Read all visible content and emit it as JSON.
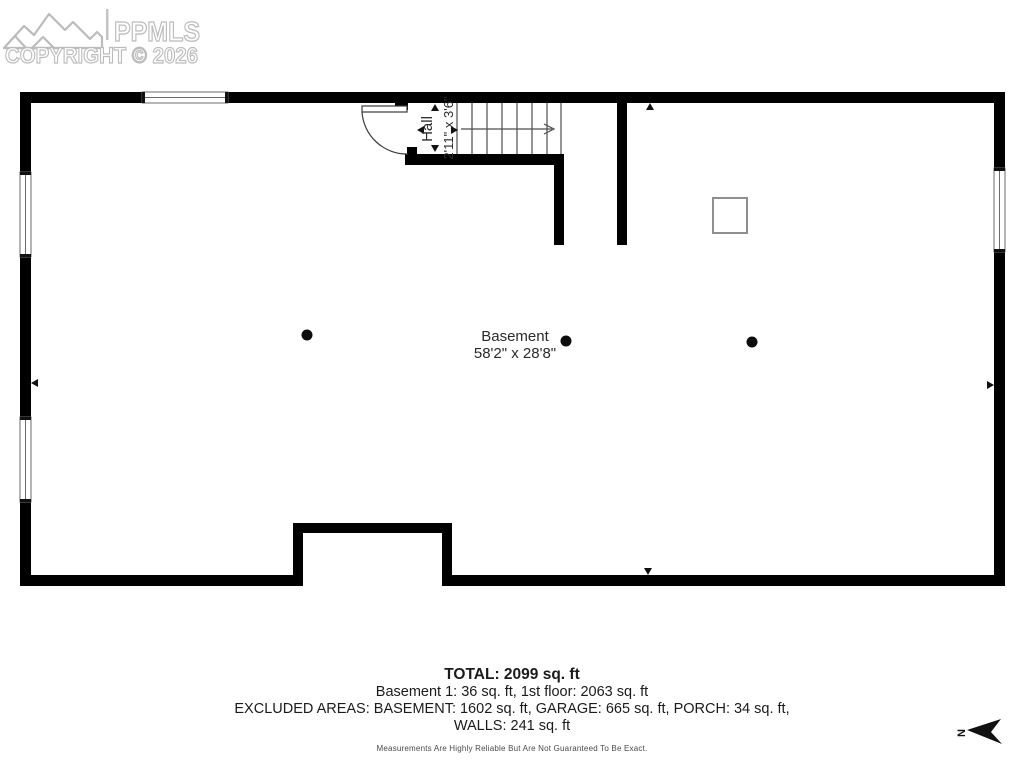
{
  "watermark": {
    "brand": "PPMLS",
    "copyright": "COPYRIGHT © 2026",
    "color": "#bcbcbc"
  },
  "floorplan": {
    "rooms": {
      "hall": {
        "name": "Hall",
        "dims": "2'11\" x 3'6\""
      },
      "basement": {
        "name": "Basement",
        "dims": "58'2\" x 28'8\""
      }
    },
    "wall_color": "#000000",
    "features": [
      "stairs-up",
      "entry-door",
      "three-support-posts",
      "utility-box",
      "four-windows",
      "bottom-bump-out"
    ]
  },
  "summary": {
    "total": "TOTAL: 2099 sq. ft",
    "breakdown": "Basement 1: 36 sq. ft, 1st floor: 2063 sq. ft",
    "excluded": "EXCLUDED AREAS: BASEMENT: 1602 sq. ft, GARAGE: 665 sq. ft, PORCH: 34 sq. ft,",
    "walls": "WALLS: 241 sq. ft",
    "disclaimer": "Measurements Are Highly Reliable But Are Not Guaranteed To Be Exact."
  },
  "compass": {
    "label": "N"
  }
}
